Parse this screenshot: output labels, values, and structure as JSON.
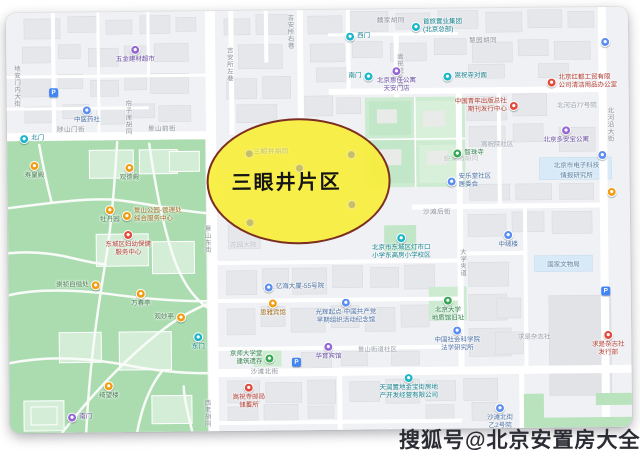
{
  "region_overlay": {
    "label": "三眼井片区",
    "cx": 297,
    "cy": 179,
    "rx": 90,
    "ry": 61,
    "fill_color": "rgba(248,238,58,0.92)",
    "border_color": "#7b2e21"
  },
  "watermark": {
    "text": "搜狐号@北京安置房大全",
    "color": "#2c2d34"
  },
  "map": {
    "palette": {
      "teal": "#1bb6c9",
      "blue": "#5b8ef0",
      "purple": "#9467d4",
      "orange": "#f29c12",
      "red": "#e14b3d",
      "green": "#34a853",
      "parking": "#4285f4",
      "label": {
        "teal": "#0f7f8c",
        "blue": "#4a6fa5",
        "purple": "#6a4fa3",
        "orange": "#9c6b1f",
        "red": "#b03a30",
        "green": "#2f7d4b",
        "parking": "#4a6fa5",
        "park": "#417a4d"
      }
    },
    "markers": [
      {
        "x": 137,
        "y": 48,
        "c": "purple",
        "l": "五金建材超市"
      },
      {
        "x": 55,
        "y": 90,
        "c": "parking"
      },
      {
        "x": 88,
        "y": 108,
        "c": "blue",
        "l": "中医药社"
      },
      {
        "x": 25,
        "y": 136,
        "c": "teal",
        "l": "北门",
        "s": "r"
      },
      {
        "x": 35,
        "y": 163,
        "c": "orange",
        "l": "寿皇殿",
        "park": 1
      },
      {
        "x": 130,
        "y": 166,
        "c": "orange",
        "l": "观德殿",
        "park": 1
      },
      {
        "x": 110,
        "y": 208,
        "c": "orange",
        "l": "牡丹园",
        "park": 1
      },
      {
        "x": 127,
        "y": 214,
        "c": "orange",
        "l": "景山公园-管理处\n综合服务中心",
        "s": "r"
      },
      {
        "x": 128,
        "y": 233,
        "c": "red",
        "l": "东城区妇幼保健\n服务中心"
      },
      {
        "x": 95,
        "y": 283,
        "c": "orange",
        "l": "崇祯自缢处",
        "s": "l",
        "park": 1
      },
      {
        "x": 140,
        "y": 292,
        "c": "orange",
        "l": "万春亭",
        "park": 1
      },
      {
        "x": 180,
        "y": 316,
        "c": "orange",
        "l": "观妙亭",
        "s": "l",
        "park": 1
      },
      {
        "x": 197,
        "y": 336,
        "c": "teal",
        "l": "东门"
      },
      {
        "x": 107,
        "y": 384,
        "c": "orange",
        "l": "绮望楼",
        "park": 1
      },
      {
        "x": 70,
        "y": 415,
        "c": "purple",
        "l": "南门",
        "s": "r"
      },
      {
        "x": 98,
        "y": 436,
        "c": "orange"
      },
      {
        "x": 148,
        "y": 438,
        "c": "orange"
      },
      {
        "x": 352,
        "y": 37,
        "c": "teal",
        "l": "西门",
        "s": "r"
      },
      {
        "x": 418,
        "y": 28,
        "c": "teal",
        "l": "首旅置业集团\n(北京总部)",
        "s": "r"
      },
      {
        "x": 398,
        "y": 72,
        "c": "purple",
        "l": "北京惠佳公寓\n天安门店"
      },
      {
        "x": 370,
        "y": 77,
        "c": "teal",
        "l": "南门",
        "s": "l"
      },
      {
        "x": 449,
        "y": 78,
        "c": "teal",
        "l": "嵩祝寺对面",
        "s": "r"
      },
      {
        "x": 553,
        "y": 85,
        "c": "red",
        "l": "北京红都工贸有限\n公司清洁用品办公室",
        "s": "r"
      },
      {
        "x": 607,
        "y": 45,
        "c": "blue"
      },
      {
        "x": 515,
        "y": 108,
        "c": "red",
        "l": "中国青年出版总社\n期刊发行中心",
        "s": "l"
      },
      {
        "x": 567,
        "y": 133,
        "c": "purple",
        "l": "北京多安宝公寓"
      },
      {
        "x": 458,
        "y": 155,
        "c": "green",
        "l": "智珠寺",
        "s": "r"
      },
      {
        "x": 452,
        "y": 183,
        "c": "blue",
        "l": "安乐堂社区\n居委会",
        "s": "r"
      },
      {
        "x": 603,
        "y": 158,
        "c": "blue"
      },
      {
        "x": 612,
        "y": 195,
        "c": "orange"
      },
      {
        "x": 508,
        "y": 237,
        "c": "blue",
        "l": "中绒楼"
      },
      {
        "x": 605,
        "y": 294,
        "c": "parking"
      },
      {
        "x": 401,
        "y": 239,
        "c": "teal",
        "l": "北京市东城区灯市口\n小学东高房小学校区"
      },
      {
        "x": 268,
        "y": 287,
        "c": "blue",
        "l": "亿海大厦-55号院",
        "s": "r"
      },
      {
        "x": 272,
        "y": 303,
        "c": "orange",
        "l": "思雅宾馆"
      },
      {
        "x": 345,
        "y": 303,
        "c": "blue",
        "l": "光辉起点·中国共产党\n早期组织活动纪念馆"
      },
      {
        "x": 447,
        "y": 302,
        "c": "green",
        "l": "北京大学\n地质馆旧址"
      },
      {
        "x": 456,
        "y": 332,
        "c": "blue",
        "l": "中国社会科学院\n法学研究所"
      },
      {
        "x": 268,
        "y": 358,
        "c": "green",
        "l": "京师大学堂\n建筑遗存",
        "s": "l"
      },
      {
        "x": 295,
        "y": 362,
        "c": "parking"
      },
      {
        "x": 327,
        "y": 347,
        "c": "purple",
        "l": "华育宾馆"
      },
      {
        "x": 247,
        "y": 387,
        "c": "red",
        "l": "嵩祝寺邮局\n储蓄所"
      },
      {
        "x": 407,
        "y": 379,
        "c": "teal",
        "l": "天润置地金宝街房地\n产开发经营有限公司"
      },
      {
        "x": 498,
        "y": 410,
        "c": "blue",
        "l": "沙滩北街\n乙2号院"
      },
      {
        "x": 388,
        "y": 434,
        "c": "purple"
      },
      {
        "x": 607,
        "y": 338,
        "c": "red",
        "l": "求是杂志社\n发行部"
      },
      {
        "x": 250,
        "y": 153,
        "c": "ghost"
      },
      {
        "x": 300,
        "y": 168,
        "c": "ghost"
      },
      {
        "x": 352,
        "y": 155,
        "c": "ghost"
      },
      {
        "x": 250,
        "y": 222,
        "c": "ghost"
      },
      {
        "x": 352,
        "y": 205,
        "c": "ghost"
      }
    ],
    "street_labels": [
      {
        "t": "地安门内大街",
        "x": 17,
        "y": 62,
        "v": 1
      },
      {
        "t": "帘子库胡同",
        "x": 128,
        "y": 98,
        "v": 1
      },
      {
        "t": "陟山门街",
        "x": 72,
        "y": 126
      },
      {
        "t": "景山前街",
        "x": 163,
        "y": 126
      },
      {
        "t": "景山东街",
        "x": 206,
        "y": 224,
        "v": 1
      },
      {
        "t": "吉安所左巷",
        "x": 230,
        "y": 46,
        "v": 1
      },
      {
        "t": "吉安所右巷",
        "x": 291,
        "y": 14,
        "v": 1
      },
      {
        "t": "嵩祝院北巷",
        "x": 400,
        "y": 54,
        "v": 1
      },
      {
        "t": "魏家胡同",
        "x": 393,
        "y": 20
      },
      {
        "t": "慧园胡同",
        "x": 485,
        "y": 41
      },
      {
        "t": "沙滩后街",
        "x": 437,
        "y": 212
      },
      {
        "t": "北河沿大街",
        "x": 610,
        "y": 110,
        "v": 1
      },
      {
        "t": "沙滩北街",
        "x": 263,
        "y": 370
      },
      {
        "t": "西老胡同",
        "x": 204,
        "y": 398,
        "v": 1
      },
      {
        "t": "大学夹道",
        "x": 461,
        "y": 250,
        "v": 1
      },
      {
        "t": "织染局胡同",
        "x": 462,
        "y": 159,
        "f": 1
      },
      {
        "t": "三眼井胡同",
        "x": 272,
        "y": 150,
        "f": 1
      },
      {
        "t": "东黄城根北街",
        "x": 632,
        "y": 192,
        "v": 1,
        "f": 1
      }
    ],
    "area_labels": [
      {
        "t": "嵩祝院社区",
        "x": 498,
        "y": 145
      },
      {
        "t": "北河沿77号院",
        "x": 578,
        "y": 107
      },
      {
        "t": "北京市电子科技\n情报研究所",
        "x": 577,
        "y": 172,
        "c": "#5a7f9e"
      },
      {
        "t": "国家文物局",
        "x": 563,
        "y": 266,
        "c": "#5a7f9e"
      },
      {
        "t": "求是杂志社",
        "x": 533,
        "y": 338
      },
      {
        "t": "景山街道社区",
        "x": 376,
        "y": 349
      },
      {
        "t": "花园大院",
        "x": 243,
        "y": 243,
        "f": 1
      }
    ]
  }
}
